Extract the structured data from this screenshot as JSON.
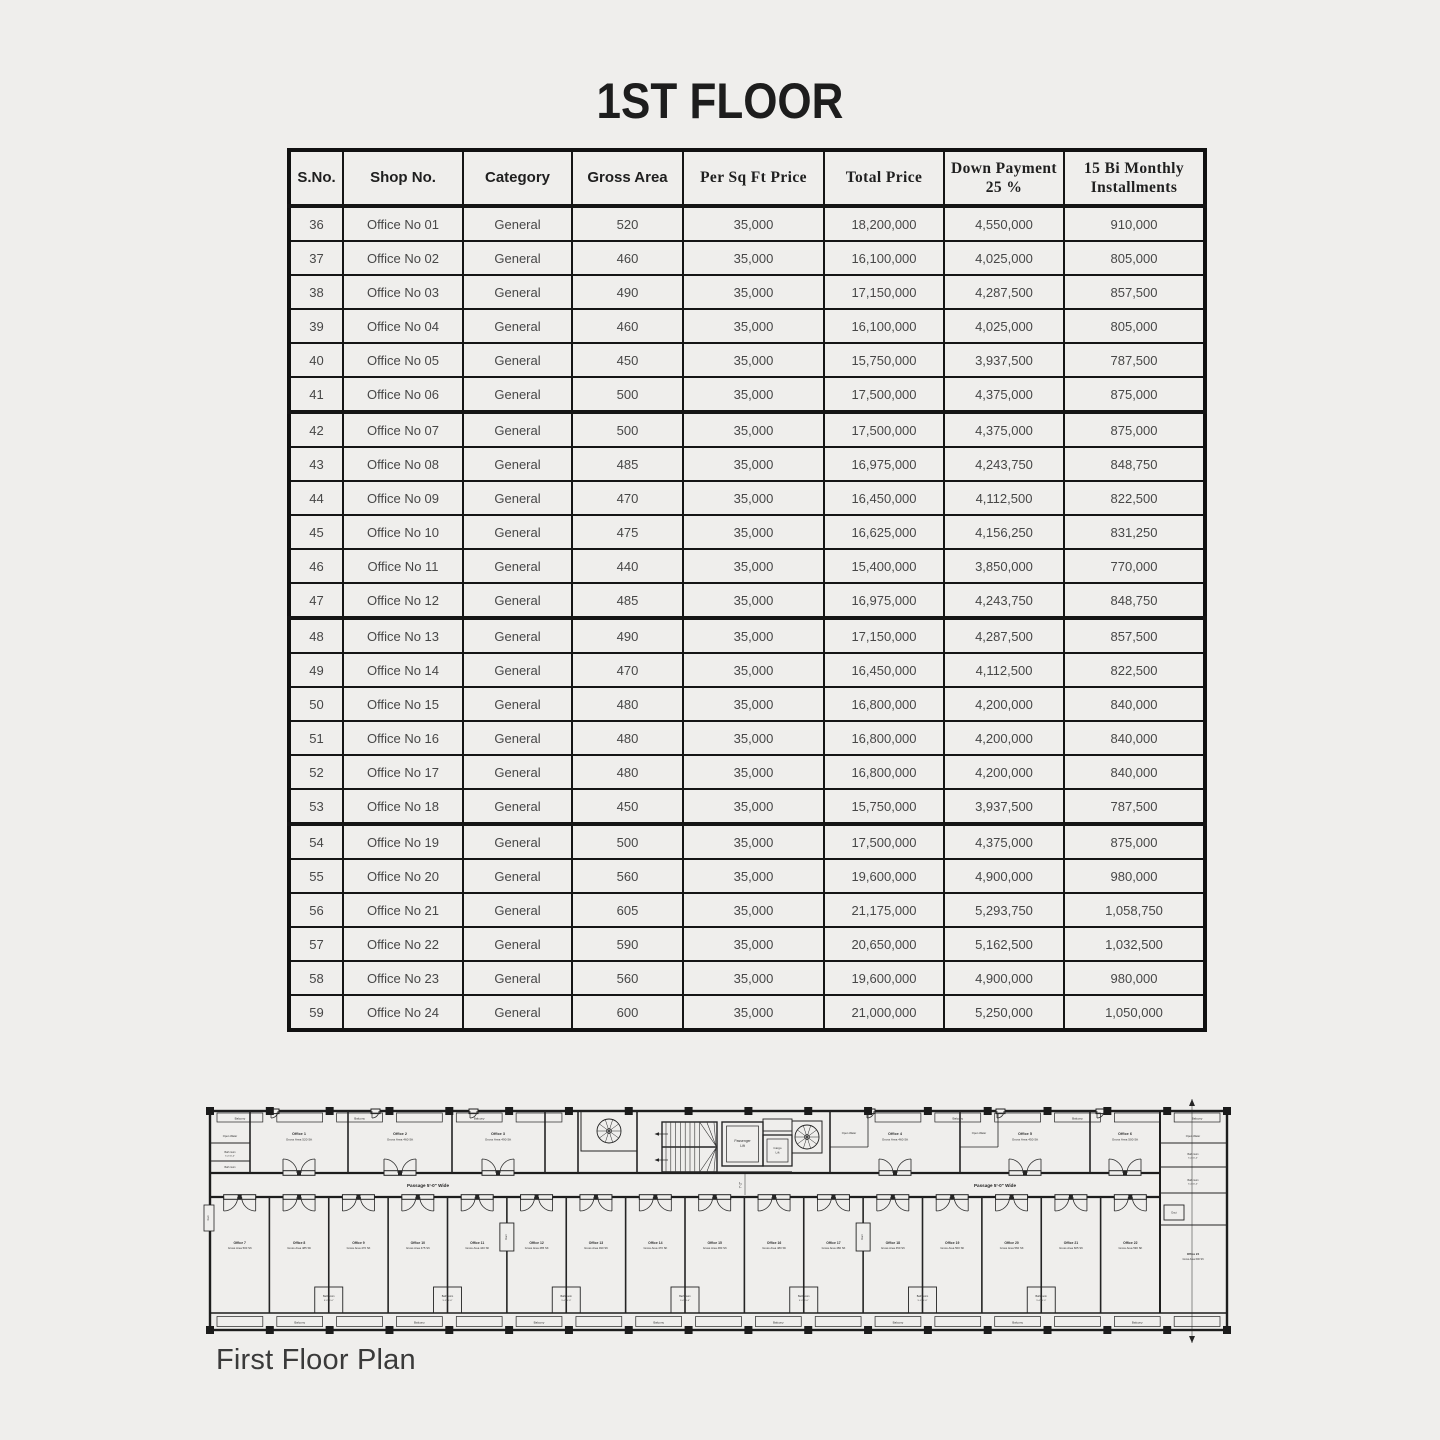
{
  "page": {
    "title": "1ST FLOOR",
    "caption": "First Floor Plan",
    "background": "#efeeec",
    "line_color": "#151515",
    "text_color": "#474747"
  },
  "table": {
    "columns": [
      {
        "label": "S.No.",
        "style": "sans"
      },
      {
        "label": "Shop No.",
        "style": "sans"
      },
      {
        "label": "Category",
        "style": "sans"
      },
      {
        "label": "Gross Area",
        "style": "sans"
      },
      {
        "label": "Per Sq Ft Price",
        "style": "serif"
      },
      {
        "label": "Total Price",
        "style": "serif"
      },
      {
        "label": "Down Payment 25 %",
        "style": "serif"
      },
      {
        "label": "15 Bi Monthly Installments",
        "style": "serif"
      }
    ],
    "rows": [
      [
        36,
        "Office No 01",
        "General",
        "520",
        "35,000",
        "18,200,000",
        "4,550,000",
        "910,000"
      ],
      [
        37,
        "Office No 02",
        "General",
        "460",
        "35,000",
        "16,100,000",
        "4,025,000",
        "805,000"
      ],
      [
        38,
        "Office No 03",
        "General",
        "490",
        "35,000",
        "17,150,000",
        "4,287,500",
        "857,500"
      ],
      [
        39,
        "Office No 04",
        "General",
        "460",
        "35,000",
        "16,100,000",
        "4,025,000",
        "805,000"
      ],
      [
        40,
        "Office No 05",
        "General",
        "450",
        "35,000",
        "15,750,000",
        "3,937,500",
        "787,500"
      ],
      [
        41,
        "Office No 06",
        "General",
        "500",
        "35,000",
        "17,500,000",
        "4,375,000",
        "875,000"
      ],
      [
        42,
        "Office No 07",
        "General",
        "500",
        "35,000",
        "17,500,000",
        "4,375,000",
        "875,000"
      ],
      [
        43,
        "Office No 08",
        "General",
        "485",
        "35,000",
        "16,975,000",
        "4,243,750",
        "848,750"
      ],
      [
        44,
        "Office No 09",
        "General",
        "470",
        "35,000",
        "16,450,000",
        "4,112,500",
        "822,500"
      ],
      [
        45,
        "Office No 10",
        "General",
        "475",
        "35,000",
        "16,625,000",
        "4,156,250",
        "831,250"
      ],
      [
        46,
        "Office No 11",
        "General",
        "440",
        "35,000",
        "15,400,000",
        "3,850,000",
        "770,000"
      ],
      [
        47,
        "Office No 12",
        "General",
        "485",
        "35,000",
        "16,975,000",
        "4,243,750",
        "848,750"
      ],
      [
        48,
        "Office No 13",
        "General",
        "490",
        "35,000",
        "17,150,000",
        "4,287,500",
        "857,500"
      ],
      [
        49,
        "Office No 14",
        "General",
        "470",
        "35,000",
        "16,450,000",
        "4,112,500",
        "822,500"
      ],
      [
        50,
        "Office No 15",
        "General",
        "480",
        "35,000",
        "16,800,000",
        "4,200,000",
        "840,000"
      ],
      [
        51,
        "Office No 16",
        "General",
        "480",
        "35,000",
        "16,800,000",
        "4,200,000",
        "840,000"
      ],
      [
        52,
        "Office No 17",
        "General",
        "480",
        "35,000",
        "16,800,000",
        "4,200,000",
        "840,000"
      ],
      [
        53,
        "Office No 18",
        "General",
        "450",
        "35,000",
        "15,750,000",
        "3,937,500",
        "787,500"
      ],
      [
        54,
        "Office No 19",
        "General",
        "500",
        "35,000",
        "17,500,000",
        "4,375,000",
        "875,000"
      ],
      [
        55,
        "Office No 20",
        "General",
        "560",
        "35,000",
        "19,600,000",
        "4,900,000",
        "980,000"
      ],
      [
        56,
        "Office No 21",
        "General",
        "605",
        "35,000",
        "21,175,000",
        "5,293,750",
        "1,058,750"
      ],
      [
        57,
        "Office No 22",
        "General",
        "590",
        "35,000",
        "20,650,000",
        "5,162,500",
        "1,032,500"
      ],
      [
        58,
        "Office No 23",
        "General",
        "560",
        "35,000",
        "19,600,000",
        "4,900,000",
        "980,000"
      ],
      [
        59,
        "Office No 24",
        "General",
        "600",
        "35,000",
        "21,000,000",
        "5,250,000",
        "1,050,000"
      ]
    ]
  },
  "plan": {
    "passage_label": "Passage 5'-0\" Wide",
    "passenger_lift_line1": "Passenger",
    "passenger_lift_line2": "Lift",
    "cargo_lift_line1": "Cargo",
    "cargo_lift_line2": "Lift",
    "balcony": "Balcony",
    "bath_line1": "Bath room",
    "bath_line2": "5'-0\"x5'-0\"",
    "open_water": "Open Water",
    "duct": "Duct",
    "stair_dim": "7'-2\"",
    "top_offices": [
      {
        "name": "Office 1",
        "area": "Gross Area 520 Sft"
      },
      {
        "name": "Office 2",
        "area": "Gross Area 460 Sft"
      },
      {
        "name": "Office 3",
        "area": "Gross Area 490 Sft"
      },
      {
        "name": "Office 4",
        "area": "Gross Area 460 Sft"
      },
      {
        "name": "Office 5",
        "area": "Gross Area 450 Sft"
      },
      {
        "name": "Office 6",
        "area": "Gross Area 500 Sft"
      }
    ],
    "right_office": {
      "name": "Office 24",
      "area": "Gross Area 600 Sft"
    },
    "bottom_offices": [
      {
        "name": "Office 7",
        "area": "Gross Area 500 Sft"
      },
      {
        "name": "Office 8",
        "area": "Gross Area 485 Sft"
      },
      {
        "name": "Office 9",
        "area": "Gross Area 470 Sft"
      },
      {
        "name": "Office 10",
        "area": "Gross Area 475 Sft"
      },
      {
        "name": "Office 11",
        "area": "Gross Area 440 Sft"
      },
      {
        "name": "Office 12",
        "area": "Gross Area 485 Sft"
      },
      {
        "name": "Office 13",
        "area": "Gross Area 490 Sft"
      },
      {
        "name": "Office 14",
        "area": "Gross Area 470 Sft"
      },
      {
        "name": "Office 15",
        "area": "Gross Area 480 Sft"
      },
      {
        "name": "Office 16",
        "area": "Gross Area 480 Sft"
      },
      {
        "name": "Office 17",
        "area": "Gross Area 480 Sft"
      },
      {
        "name": "Office 18",
        "area": "Gross Area 450 Sft"
      },
      {
        "name": "Office 19",
        "area": "Gross Area 500 Sft"
      },
      {
        "name": "Office 20",
        "area": "Gross Area 560 Sft"
      },
      {
        "name": "Office 21",
        "area": "Gross Area 605 Sft"
      },
      {
        "name": "Office 22",
        "area": "Gross Area 590 Sft"
      }
    ]
  }
}
